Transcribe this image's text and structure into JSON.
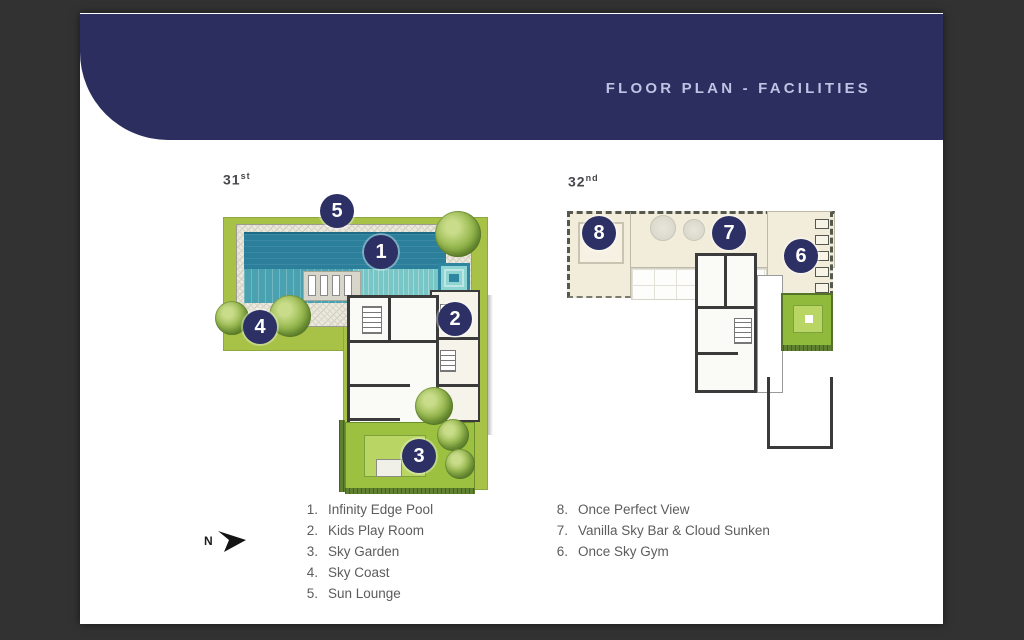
{
  "header": {
    "title": "FLOOR PLAN - FACILITIES"
  },
  "plans": [
    {
      "name": "31st-floor-plan",
      "floor_number": "31",
      "floor_suffix": "st",
      "badges": [
        {
          "n": "5"
        },
        {
          "n": "1"
        },
        {
          "n": "4"
        },
        {
          "n": "2"
        },
        {
          "n": "3"
        }
      ]
    },
    {
      "name": "32nd-floor-plan",
      "floor_number": "32",
      "floor_suffix": "nd",
      "badges": [
        {
          "n": "8"
        },
        {
          "n": "7"
        },
        {
          "n": "6"
        }
      ]
    }
  ],
  "legend_left": {
    "items": [
      {
        "num": "1.",
        "label": "Infinity Edge Pool"
      },
      {
        "num": "2.",
        "label": "Kids Play Room"
      },
      {
        "num": "3.",
        "label": "Sky Garden"
      },
      {
        "num": "4.",
        "label": "Sky Coast"
      },
      {
        "num": "5.",
        "label": "Sun Lounge"
      }
    ]
  },
  "legend_right": {
    "items": [
      {
        "num": "8.",
        "label": "Once Perfect View"
      },
      {
        "num": "7.",
        "label": "Vanilla Sky Bar & Cloud Sunken"
      },
      {
        "num": "6.",
        "label": "Once Sky Gym"
      }
    ]
  },
  "compass": {
    "label": "N"
  },
  "colors": {
    "frame_bg": "#323232",
    "page_bg": "#ffffff",
    "banner_navy": "#2b2e5f",
    "title_text": "#bdc4e4",
    "badge_navy": "#2c3064",
    "plan_green": "#a7c247",
    "pool_teal_dark": "#2b7f9b",
    "pool_teal_light": "#4aa2b0",
    "pool_step": "#79c6c6",
    "cream_floor": "#f2ecdb",
    "garden_green": "#9cc03f",
    "legend_text": "#5c5c5c",
    "wall_dark": "#3a3a3a"
  }
}
